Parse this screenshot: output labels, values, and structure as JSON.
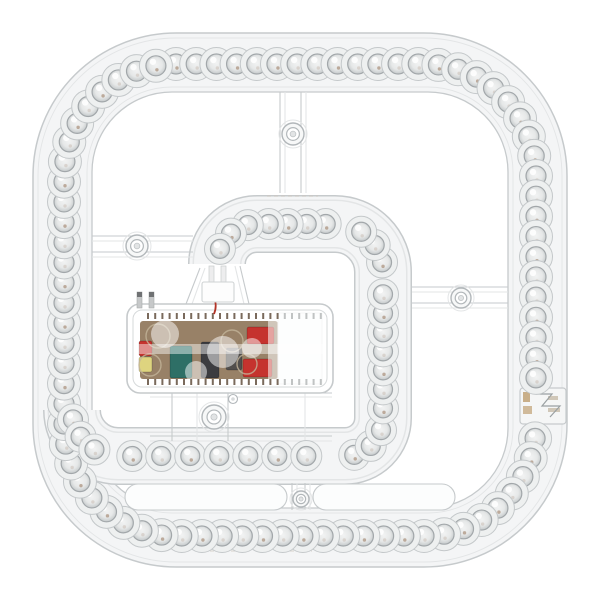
{
  "description": "Product photo of a round-square magnetic LED ceiling retrofit module with an outer LED lens ring, an inner G-shaped LED strip and a translucent driver box with PCB",
  "background": "#ffffff",
  "module": {
    "canvas": {
      "w": 600,
      "h": 600
    },
    "colors": {
      "edge": "#c6cacc",
      "edge_faint": "#e3e5e6",
      "band_fill": "#f4f5f6",
      "lens_outer_fill": "#eef0f0",
      "lens_ring": "#c4c8ca",
      "lens_inner_stroke": "#a2a7aa",
      "pcb": "#8d7356",
      "cap_red": "#c5332e",
      "cap_teal": "#2e6f66",
      "cap_yellow": "#ded47f",
      "cap_black": "#3c3c40",
      "dark_part": "#514e4c",
      "wire_red": "#b23326",
      "amber": "#b0884f",
      "pad": "#c7bca9",
      "screw": "#b2b7ba",
      "tick_dark": "#6b5a4a",
      "tick_light": "#b9bcbd",
      "pin_gray": "#c6c8c9",
      "pin_tip": "#6f7173",
      "white": "#ffffff"
    },
    "outer_ring": {
      "inset_outer": 33,
      "corner_r_outer": 143,
      "inset_outer2": 38,
      "corner_r_outer2": 138,
      "inset_inner": 92,
      "corner_r_inner": 80,
      "inset_inner2": 87,
      "corner_r_inner2": 85,
      "led_inset": 64,
      "led_corner_r": 112,
      "led_count": 84,
      "lens_outer_r": 16.5,
      "lens_inner_r": 10,
      "skip_zone": {
        "x_min": 500,
        "y_min": 384,
        "y_max": 428
      }
    },
    "inner_strip": {
      "band_width": 58,
      "path": "M 72,410 A 46,46 0 0 0 118,456 L 345,456 A 38,38 0 0 0 383,418 L 383,272 A 48,48 0 0 0 335,224 L 257,224 A 40,40 0 0 0 217,264",
      "spec_total_len": 721,
      "segments": [
        {
          "len": 72,
          "step": 19
        },
        {
          "len": 227,
          "step": 29
        },
        {
          "len": 60,
          "step": 19
        },
        {
          "len": 146,
          "step": 19
        },
        {
          "len": 75,
          "step": 19
        },
        {
          "len": 78,
          "step": 19
        },
        {
          "len": 63,
          "step": 19
        }
      ],
      "lens_outer_r": 15.5,
      "lens_inner_r": 9.5
    },
    "spokes": [
      {
        "name": "spoke-top",
        "lines": [
          [
            280,
            92,
            280,
            193
          ],
          [
            285,
            92,
            285,
            193
          ],
          [
            301,
            92,
            301,
            193
          ],
          [
            306,
            92,
            306,
            193
          ]
        ]
      },
      {
        "name": "spoke-left",
        "lines": [
          [
            92,
            236,
            193,
            236
          ],
          [
            92,
            241,
            193,
            241
          ],
          [
            92,
            252,
            193,
            252
          ],
          [
            92,
            257,
            193,
            257
          ]
        ]
      },
      {
        "name": "spoke-right",
        "lines": [
          [
            412,
            287,
            508,
            287
          ],
          [
            412,
            292,
            508,
            292
          ],
          [
            412,
            303,
            508,
            303
          ],
          [
            412,
            308,
            508,
            308
          ]
        ]
      },
      {
        "name": "spoke-bottom",
        "lines": [
          [
            292,
            483,
            292,
            510
          ],
          [
            297,
            483,
            297,
            510
          ],
          [
            305,
            483,
            305,
            510
          ],
          [
            310,
            483,
            310,
            510
          ]
        ]
      },
      {
        "name": "frame-under-driver",
        "lines": [
          [
            150,
            393,
            332,
            393
          ],
          [
            150,
            397,
            332,
            397
          ],
          [
            150,
            436,
            332,
            436
          ],
          [
            150,
            441,
            332,
            441
          ],
          [
            172,
            393,
            172,
            441
          ],
          [
            197,
            393,
            197,
            441
          ],
          [
            228,
            393,
            228,
            441
          ],
          [
            305,
            393,
            305,
            441
          ]
        ]
      },
      {
        "name": "driver-funnel",
        "lines": [
          [
            200,
            268,
            186,
            304
          ],
          [
            205,
            268,
            192,
            304
          ],
          [
            240,
            266,
            249,
            304
          ],
          [
            235,
            266,
            244,
            304
          ]
        ]
      }
    ],
    "screws": [
      {
        "x": 293,
        "y": 134,
        "r": 11
      },
      {
        "x": 137,
        "y": 246,
        "r": 11
      },
      {
        "x": 461,
        "y": 298,
        "r": 10
      },
      {
        "x": 214,
        "y": 417,
        "r": 12
      },
      {
        "x": 301,
        "y": 499,
        "r": 8
      }
    ],
    "small_holes": [
      {
        "x": 233,
        "y": 399,
        "r": 4.5
      }
    ],
    "slots": [
      {
        "x": 125,
        "y": 484,
        "w": 162,
        "h": 26
      },
      {
        "x": 313,
        "y": 484,
        "w": 142,
        "h": 26
      }
    ],
    "joint": {
      "x": 520,
      "y": 388,
      "w": 46,
      "h": 36
    },
    "driver": {
      "box": {
        "x": 127,
        "y": 304,
        "w": 206,
        "h": 89,
        "rx": 13
      },
      "inner_box": {
        "x": 133,
        "y": 310,
        "w": 194,
        "h": 77,
        "rx": 9
      },
      "pcb": {
        "x": 140,
        "y": 321,
        "w": 138,
        "h": 58
      },
      "sheet": {
        "x": 278,
        "y": 313,
        "w": 44,
        "h": 71
      },
      "vents": {
        "x0": 147,
        "x1": 322,
        "step": 7.2,
        "top_y": 313,
        "bot_y": 379,
        "h": 6
      },
      "components": [
        {
          "type": "rect",
          "x": 139,
          "y": 341,
          "w": 13,
          "h": 15,
          "fill": "cap_red"
        },
        {
          "type": "rect",
          "x": 139,
          "y": 357,
          "w": 13,
          "h": 15,
          "fill": "cap_yellow"
        },
        {
          "type": "rect",
          "x": 170,
          "y": 346,
          "w": 22,
          "h": 32,
          "fill": "cap_teal"
        },
        {
          "type": "rect",
          "x": 201,
          "y": 342,
          "w": 18,
          "h": 36,
          "fill": "cap_black"
        },
        {
          "type": "rect",
          "x": 226,
          "y": 348,
          "w": 16,
          "h": 22,
          "fill": "dark_part"
        },
        {
          "type": "rect",
          "x": 247,
          "y": 327,
          "w": 27,
          "h": 17,
          "fill": "cap_red"
        },
        {
          "type": "rect",
          "x": 243,
          "y": 359,
          "w": 29,
          "h": 18,
          "fill": "cap_red"
        },
        {
          "type": "circle",
          "cx": 158,
          "cy": 336,
          "r": 12
        },
        {
          "type": "circle",
          "cx": 150,
          "cy": 365,
          "r": 11
        },
        {
          "type": "circle",
          "cx": 232,
          "cy": 341,
          "r": 11
        },
        {
          "type": "circle",
          "cx": 247,
          "cy": 364,
          "r": 10
        }
      ],
      "pins": [
        {
          "x": 137,
          "y": 292,
          "w": 5,
          "h": 16
        },
        {
          "x": 149,
          "y": 292,
          "w": 5,
          "h": 16
        }
      ],
      "connector": {
        "x": 202,
        "y": 282,
        "w": 32,
        "h": 20
      },
      "connector_pins": [
        {
          "x": 209,
          "y": 266,
          "w": 5,
          "h": 16
        },
        {
          "x": 221,
          "y": 266,
          "w": 5,
          "h": 16
        }
      ],
      "red_wire": "M 215,286 C 211,296 219,302 214,314"
    },
    "markings": [
      [
        196,
        551,
        247,
        551
      ],
      [
        283,
        551,
        312,
        551
      ],
      [
        267,
        196,
        318,
        196
      ]
    ]
  }
}
